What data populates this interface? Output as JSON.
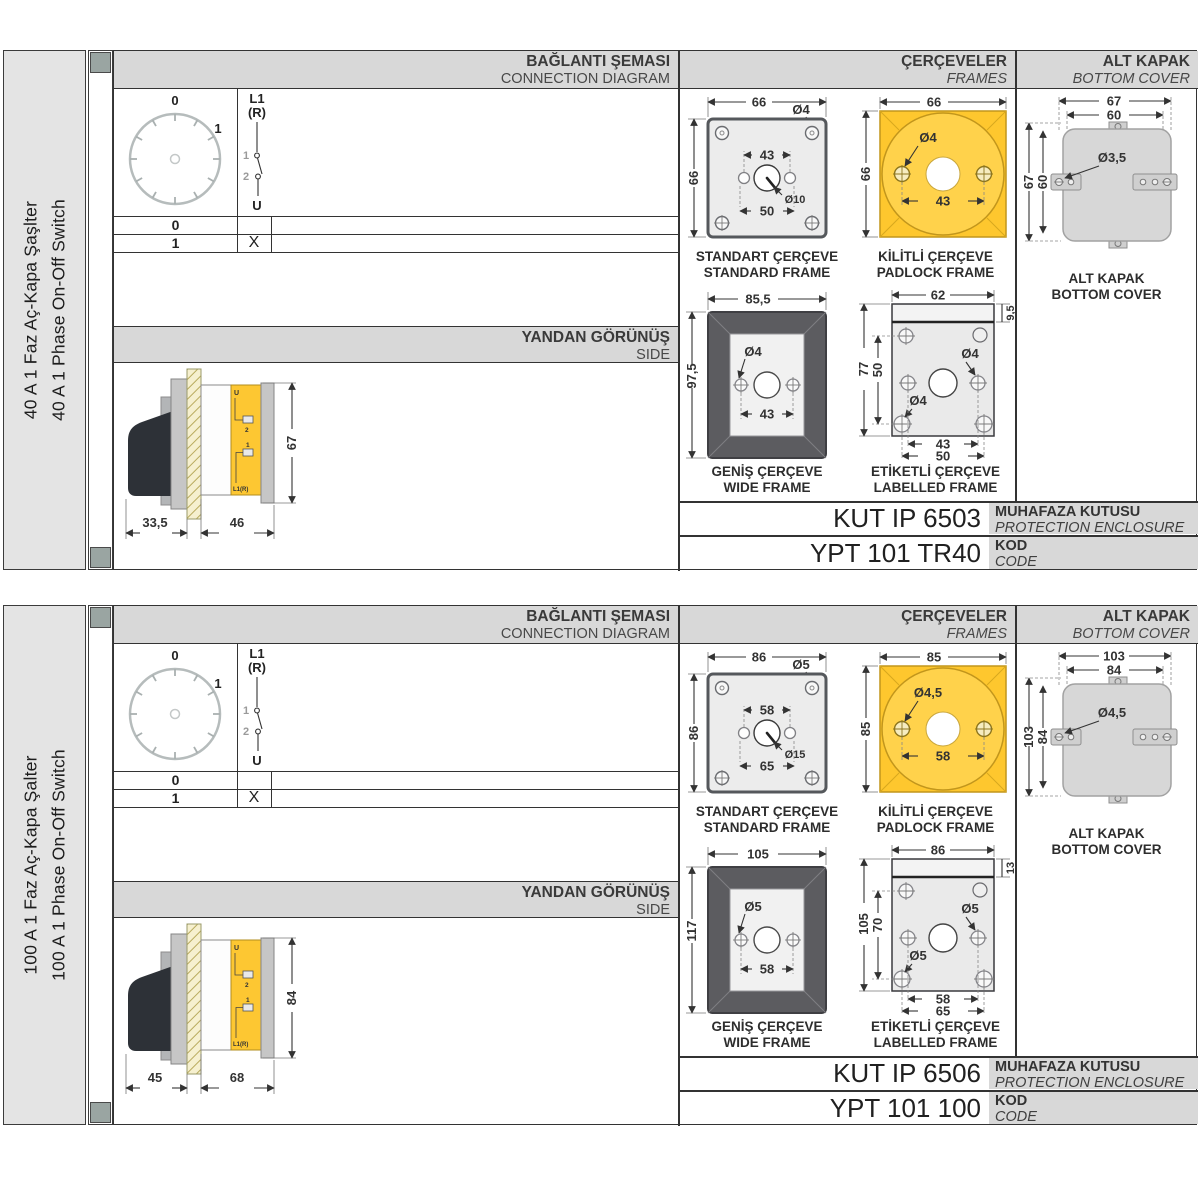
{
  "colors": {
    "accent_yellow": "#fec72e",
    "padlock_circle_yellow": "#ffd24b",
    "wide_frame_gray": "#5c5c60",
    "header_gray": "#d8d8d8",
    "sidebar_gray": "#e4e4e4",
    "spine_mark_gray": "#9aa5a2",
    "handle_black": "#2d3137",
    "cover_gray": "#d7d7d7",
    "border_dark": "#333333"
  },
  "sections": [
    {
      "sidebar": {
        "title_tr": "40 A 1 Faz Aç-Kapa Şaşlter",
        "title_en": "40 A 1 Phase On-Off Switch"
      },
      "connection": {
        "title_tr": "BAĞLANTI ŞEMASI",
        "title_en": "CONNECTION DIAGRAM",
        "dial": {
          "pos0": "0",
          "pos1": "1"
        },
        "switch": {
          "line_top": "L1",
          "line_top2": "(R)",
          "contact1": "1",
          "contact2": "2",
          "line_bottom": "U"
        },
        "table": {
          "r0_pos": "0",
          "r0_mark": "",
          "r1_pos": "1",
          "r1_mark": "X"
        }
      },
      "side": {
        "title_tr": "YANDAN GÖRÜNÜŞ",
        "title_en": "SIDE",
        "dim_depth_front": "33,5",
        "dim_depth_body": "46",
        "dim_height": "67",
        "label_u": "U",
        "label_2": "2",
        "label_1": "1",
        "label_l1r": "L1(R)"
      },
      "frames": {
        "title_tr": "ÇERÇEVELER",
        "title_en": "FRAMES",
        "standard": {
          "caption_tr": "STANDART ÇERÇEVE",
          "caption_en": "STANDARD FRAME",
          "dim_width": "66",
          "dim_height": "66",
          "dim_hole": "Ø4",
          "dim_inner": "43",
          "dim_outer": "50",
          "dim_center": "Ø10"
        },
        "padlock": {
          "caption_tr": "KİLİTLİ ÇERÇEVE",
          "caption_en": "PADLOCK FRAME",
          "dim_width": "66",
          "dim_height": "66",
          "dim_hole": "Ø4",
          "dim_span": "43"
        },
        "wide": {
          "caption_tr": "GENİŞ ÇERÇEVE",
          "caption_en": "WIDE FRAME",
          "dim_width": "85,5",
          "dim_height": "97,5",
          "dim_hole": "Ø4",
          "dim_span": "43"
        },
        "labelled": {
          "caption_tr": "ETİKETLİ ÇERÇEVE",
          "caption_en": "LABELLED FRAME",
          "dim_width": "62",
          "dim_strip": "9,5",
          "dim_height": "77",
          "dim_inner_height": "50",
          "dim_hole_mid": "Ø4",
          "dim_hole_corner": "Ø4",
          "dim_span_inner": "43",
          "dim_span_outer": "50"
        }
      },
      "cover": {
        "title_tr": "ALT KAPAK",
        "title_en": "BOTTOM COVER",
        "caption_tr": "ALT KAPAK",
        "caption_en": "BOTTOM COVER",
        "dim_w_outer": "67",
        "dim_w_inner": "60",
        "dim_h_outer": "67",
        "dim_h_inner": "60",
        "dim_hole": "Ø3,5"
      },
      "enclosure": {
        "value": "KUT IP 6503",
        "label_tr": "MUHAFAZA KUTUSU",
        "label_en": "PROTECTION ENCLOSURE"
      },
      "code": {
        "value": "YPT 101 TR40",
        "label_tr": "KOD",
        "label_en": "CODE"
      }
    },
    {
      "sidebar": {
        "title_tr": "100 A 1 Faz Aç-Kapa Şalter",
        "title_en": "100 A 1 Phase On-Off Switch"
      },
      "connection": {
        "title_tr": "BAĞLANTI ŞEMASI",
        "title_en": "CONNECTION DIAGRAM",
        "dial": {
          "pos0": "0",
          "pos1": "1"
        },
        "switch": {
          "line_top": "L1",
          "line_top2": "(R)",
          "contact1": "1",
          "contact2": "2",
          "line_bottom": "U"
        },
        "table": {
          "r0_pos": "0",
          "r0_mark": "",
          "r1_pos": "1",
          "r1_mark": "X"
        }
      },
      "side": {
        "title_tr": "YANDAN GÖRÜNÜŞ",
        "title_en": "SIDE",
        "dim_depth_front": "45",
        "dim_depth_body": "68",
        "dim_height": "84",
        "label_u": "U",
        "label_2": "2",
        "label_1": "1",
        "label_l1r": "L1(R)"
      },
      "frames": {
        "title_tr": "ÇERÇEVELER",
        "title_en": "FRAMES",
        "standard": {
          "caption_tr": "STANDART ÇERÇEVE",
          "caption_en": "STANDARD FRAME",
          "dim_width": "86",
          "dim_height": "86",
          "dim_hole": "Ø5",
          "dim_inner": "58",
          "dim_outer": "65",
          "dim_center": "Ø15"
        },
        "padlock": {
          "caption_tr": "KİLİTLİ ÇERÇEVE",
          "caption_en": "PADLOCK FRAME",
          "dim_width": "85",
          "dim_height": "85",
          "dim_hole": "Ø4,5",
          "dim_span": "58"
        },
        "wide": {
          "caption_tr": "GENİŞ ÇERÇEVE",
          "caption_en": "WIDE FRAME",
          "dim_width": "105",
          "dim_height": "117",
          "dim_hole": "Ø5",
          "dim_span": "58"
        },
        "labelled": {
          "caption_tr": "ETİKETLİ ÇERÇEVE",
          "caption_en": "LABELLED FRAME",
          "dim_width": "86",
          "dim_strip": "13",
          "dim_height": "105",
          "dim_inner_height": "70",
          "dim_hole_mid": "Ø5",
          "dim_hole_corner": "Ø5",
          "dim_span_inner": "58",
          "dim_span_outer": "65"
        }
      },
      "cover": {
        "title_tr": "ALT KAPAK",
        "title_en": "BOTTOM COVER",
        "caption_tr": "ALT KAPAK",
        "caption_en": "BOTTOM COVER",
        "dim_w_outer": "103",
        "dim_w_inner": "84",
        "dim_h_outer": "103",
        "dim_h_inner": "84",
        "dim_hole": "Ø4,5"
      },
      "enclosure": {
        "value": "KUT IP 6506",
        "label_tr": "MUHAFAZA KUTUSU",
        "label_en": "PROTECTION ENCLOSURE"
      },
      "code": {
        "value": "YPT 101 100",
        "label_tr": "KOD",
        "label_en": "CODE"
      }
    }
  ]
}
